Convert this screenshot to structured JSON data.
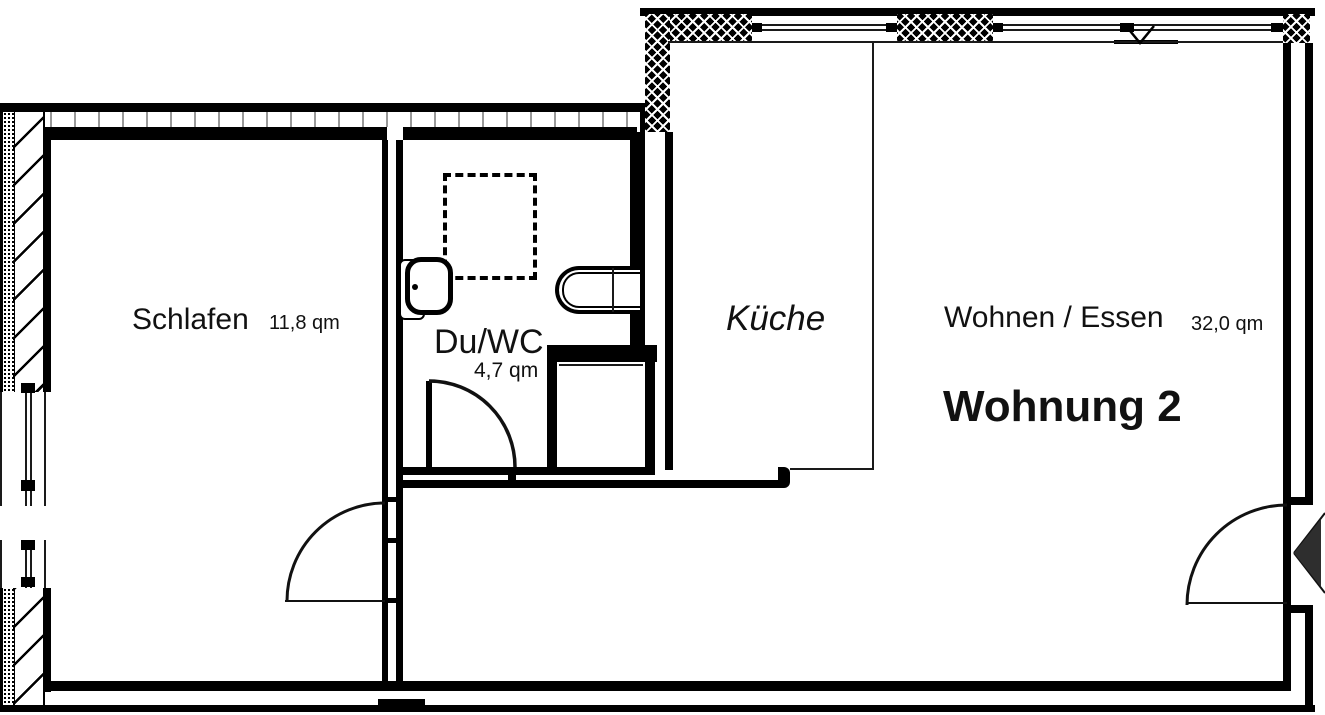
{
  "title": "Wohnung 2 Grundriss",
  "unit": {
    "label": "Wohnung 2"
  },
  "rooms": {
    "schlafen": {
      "label": "Schlafen",
      "area": "11,8 qm"
    },
    "duwc": {
      "label": "Du/WC",
      "area": "4,7 qm"
    },
    "kueche": {
      "label": "Küche"
    },
    "wohnen": {
      "label": "Wohnen / Essen",
      "area": "32,0 qm"
    }
  },
  "colors": {
    "wall": "#000000",
    "tick": "#999999",
    "entry_arrow": "#2e2e2e",
    "background": "#ffffff"
  }
}
